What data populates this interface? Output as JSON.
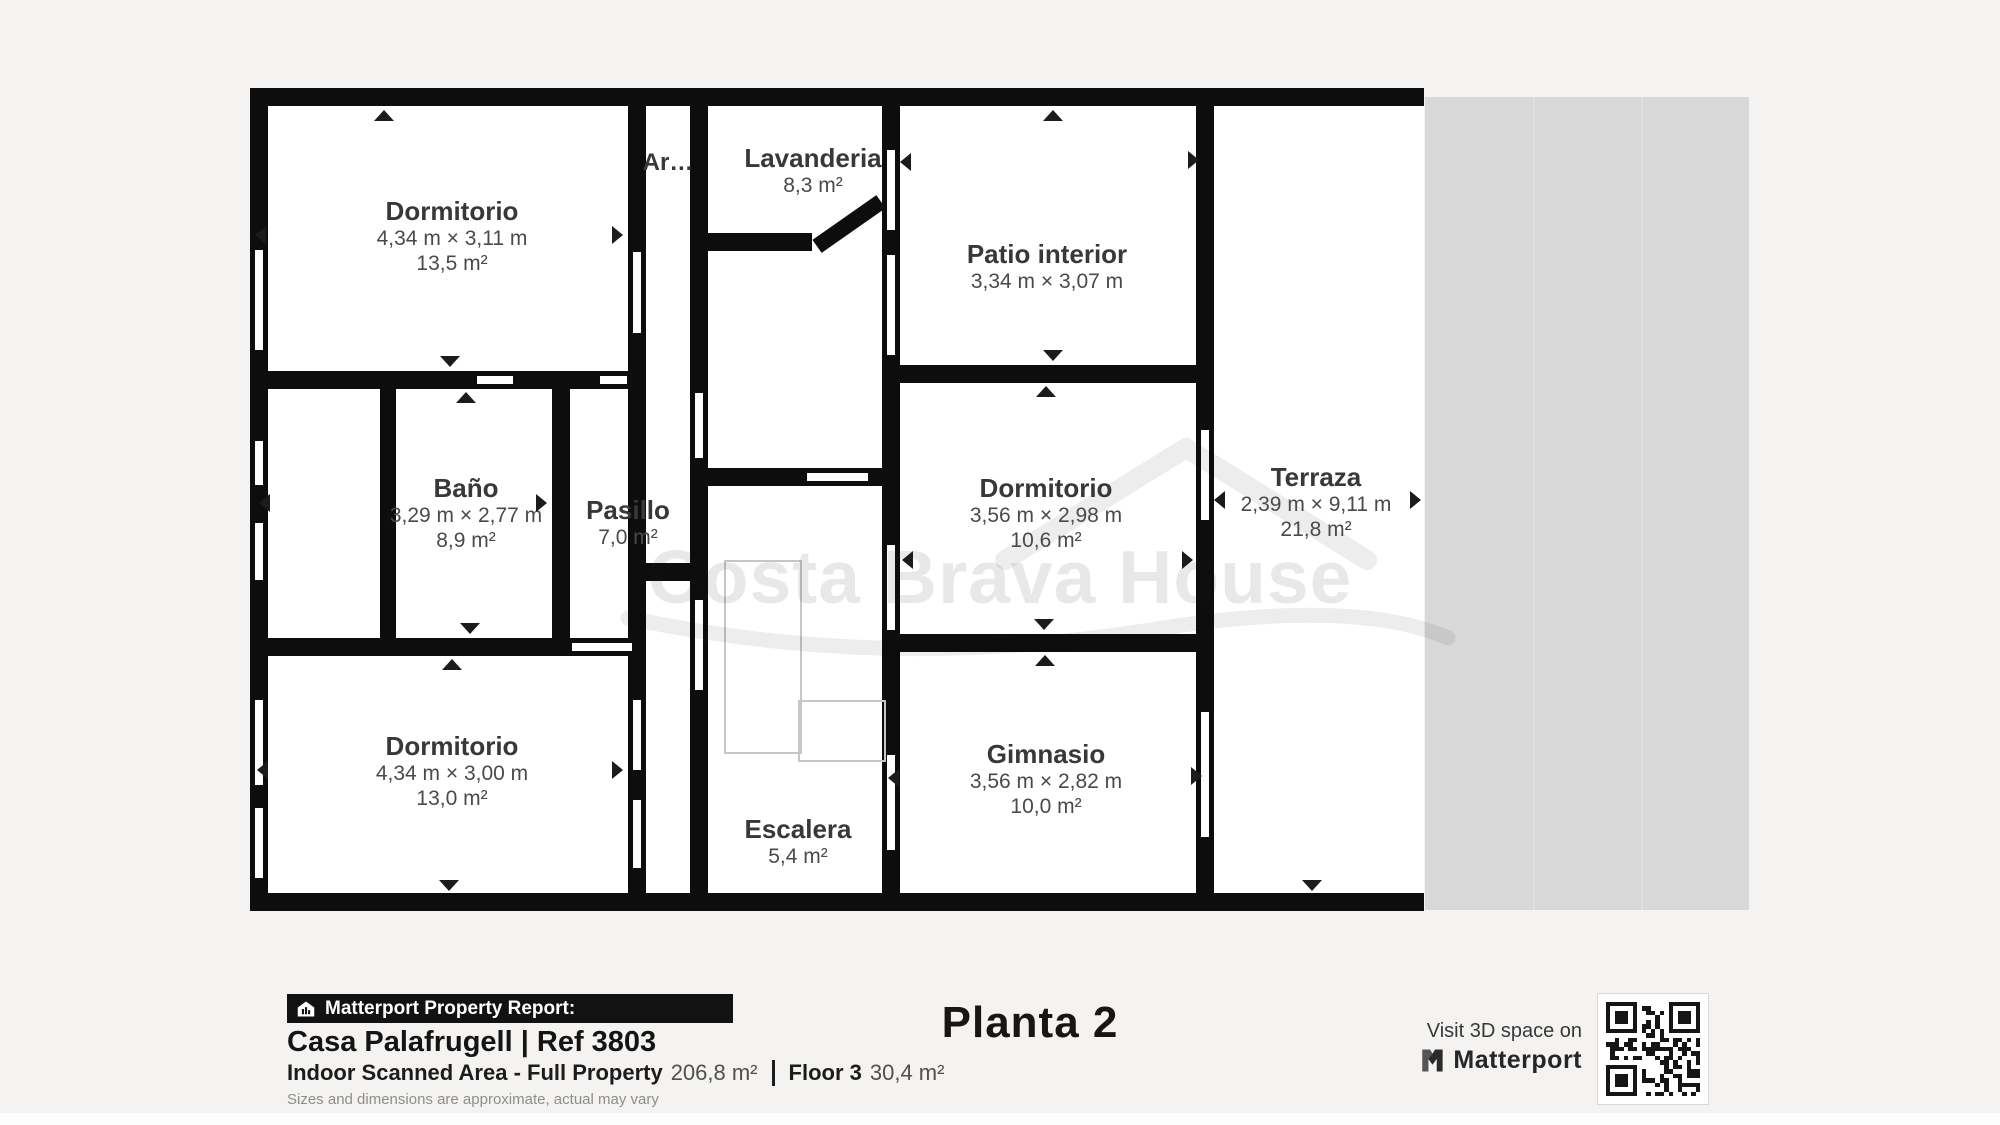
{
  "floorplan": {
    "watermark": "Costa Brava House",
    "rooms": [
      {
        "name": "Dormitorio",
        "dims": "4,34 m × 3,11 m",
        "area": "13,5 m²"
      },
      {
        "name": "Ar…"
      },
      {
        "name": "Lavanderia",
        "area": "8,3 m²"
      },
      {
        "name": "Patio interior",
        "dims": "3,34 m × 3,07 m"
      },
      {
        "name": "Baño",
        "dims": "3,29 m × 2,77 m",
        "area": "8,9 m²"
      },
      {
        "name": "Pasillo",
        "area": "7,0 m²"
      },
      {
        "name": "Dormitorio",
        "dims": "3,56 m × 2,98 m",
        "area": "10,6 m²"
      },
      {
        "name": "Terraza",
        "dims": "2,39 m × 9,11 m",
        "area": "21,8 m²"
      },
      {
        "name": "Dormitorio",
        "dims": "4,34 m × 3,00 m",
        "area": "13,0 m²"
      },
      {
        "name": "Gimnasio",
        "dims": "3,56 m × 2,82 m",
        "area": "10,0 m²"
      },
      {
        "name": "Escalera",
        "area": "5,4 m²"
      }
    ]
  },
  "footer": {
    "report_badge": "Matterport Property Report:",
    "property_title": "Casa Palafrugell | Ref 3803",
    "indoor_label": "Indoor Scanned Area - Full Property",
    "indoor_value": "206,8 m²",
    "floor_label": "Floor 3",
    "floor_value": "30,4 m²",
    "disclaimer": "Sizes and dimensions are approximate, actual may vary",
    "plan_title": "Planta 2",
    "visit_text": "Visit 3D space on",
    "brand": "Matterport"
  },
  "colors": {
    "wall": "#0d0d0d",
    "page_background": "#f4f3f1",
    "plan_background": "#ffffff",
    "exterior_gray": "#d8d8d8",
    "label_text": "#383838",
    "badge_background": "#121212"
  }
}
